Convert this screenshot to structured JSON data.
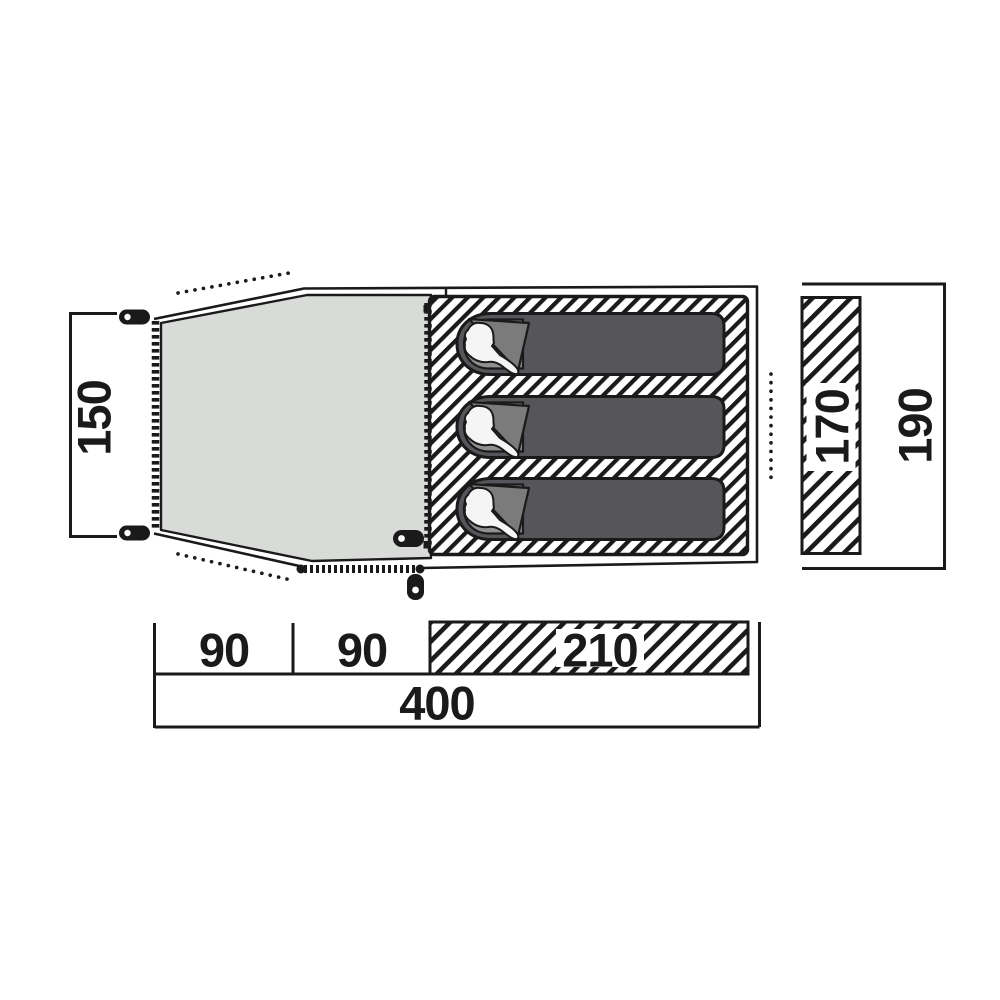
{
  "diagram": {
    "title": "tent-floorplan",
    "sleeping_bag_count": 3,
    "labels": {
      "left_height": "150",
      "inner_bar_height": "170",
      "right_height": "190",
      "segment_1": "90",
      "segment_2": "90",
      "segment_3": "210",
      "total_width": "400"
    },
    "colors": {
      "background": "#ffffff",
      "line": "#1a1a1a",
      "porch_fill": "#d9dbd9",
      "bag_body": "#56565a",
      "bag_hood": "#909090",
      "bag_flap": "#7b7b7b",
      "person_silhouette": "#f5f5f5",
      "hatch_stripe": "#1a1a1a"
    }
  }
}
